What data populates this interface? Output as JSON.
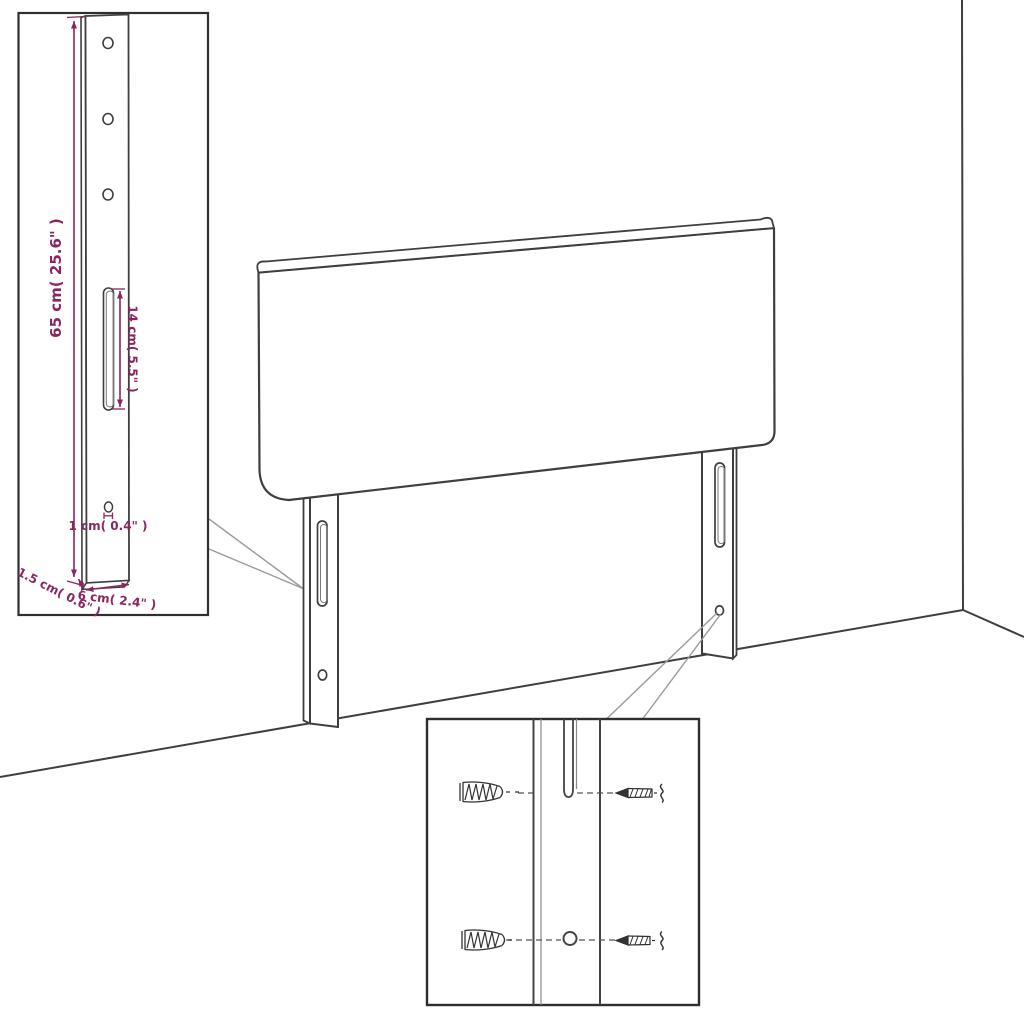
{
  "diagram": {
    "type": "furniture-assembly-dimension-diagram",
    "subject": "upholstered headboard with two slotted mounting legs, wall corner backdrop",
    "colors": {
      "background": "#ffffff",
      "outline": "#3f3f3f",
      "leader_line": "#9a9a9a",
      "dimension_annotation": "#8b2560",
      "hardware_detail": "#333333"
    },
    "dimensions": {
      "leg_height": {
        "label": "65 cm( 25.6\" )"
      },
      "slot_length": {
        "label": "14 cm( 5.5\" )"
      },
      "hole_diameter": {
        "label": "1 cm( 0.4\" )"
      },
      "leg_thickness": {
        "label": "1.5 cm( 0.6\" )"
      },
      "leg_width": {
        "label": "6 cm( 2.4\" )"
      }
    },
    "leg_detail_inset": {
      "round_holes": 3,
      "slots": 1,
      "small_hole": 1
    },
    "mounting_detail_inset": {
      "wall_plugs": 2,
      "screws": 2,
      "targets": [
        "slot",
        "round-hole"
      ]
    },
    "main_view": {
      "headboard_panels": 1,
      "legs": 2,
      "wall_corner": true
    }
  }
}
